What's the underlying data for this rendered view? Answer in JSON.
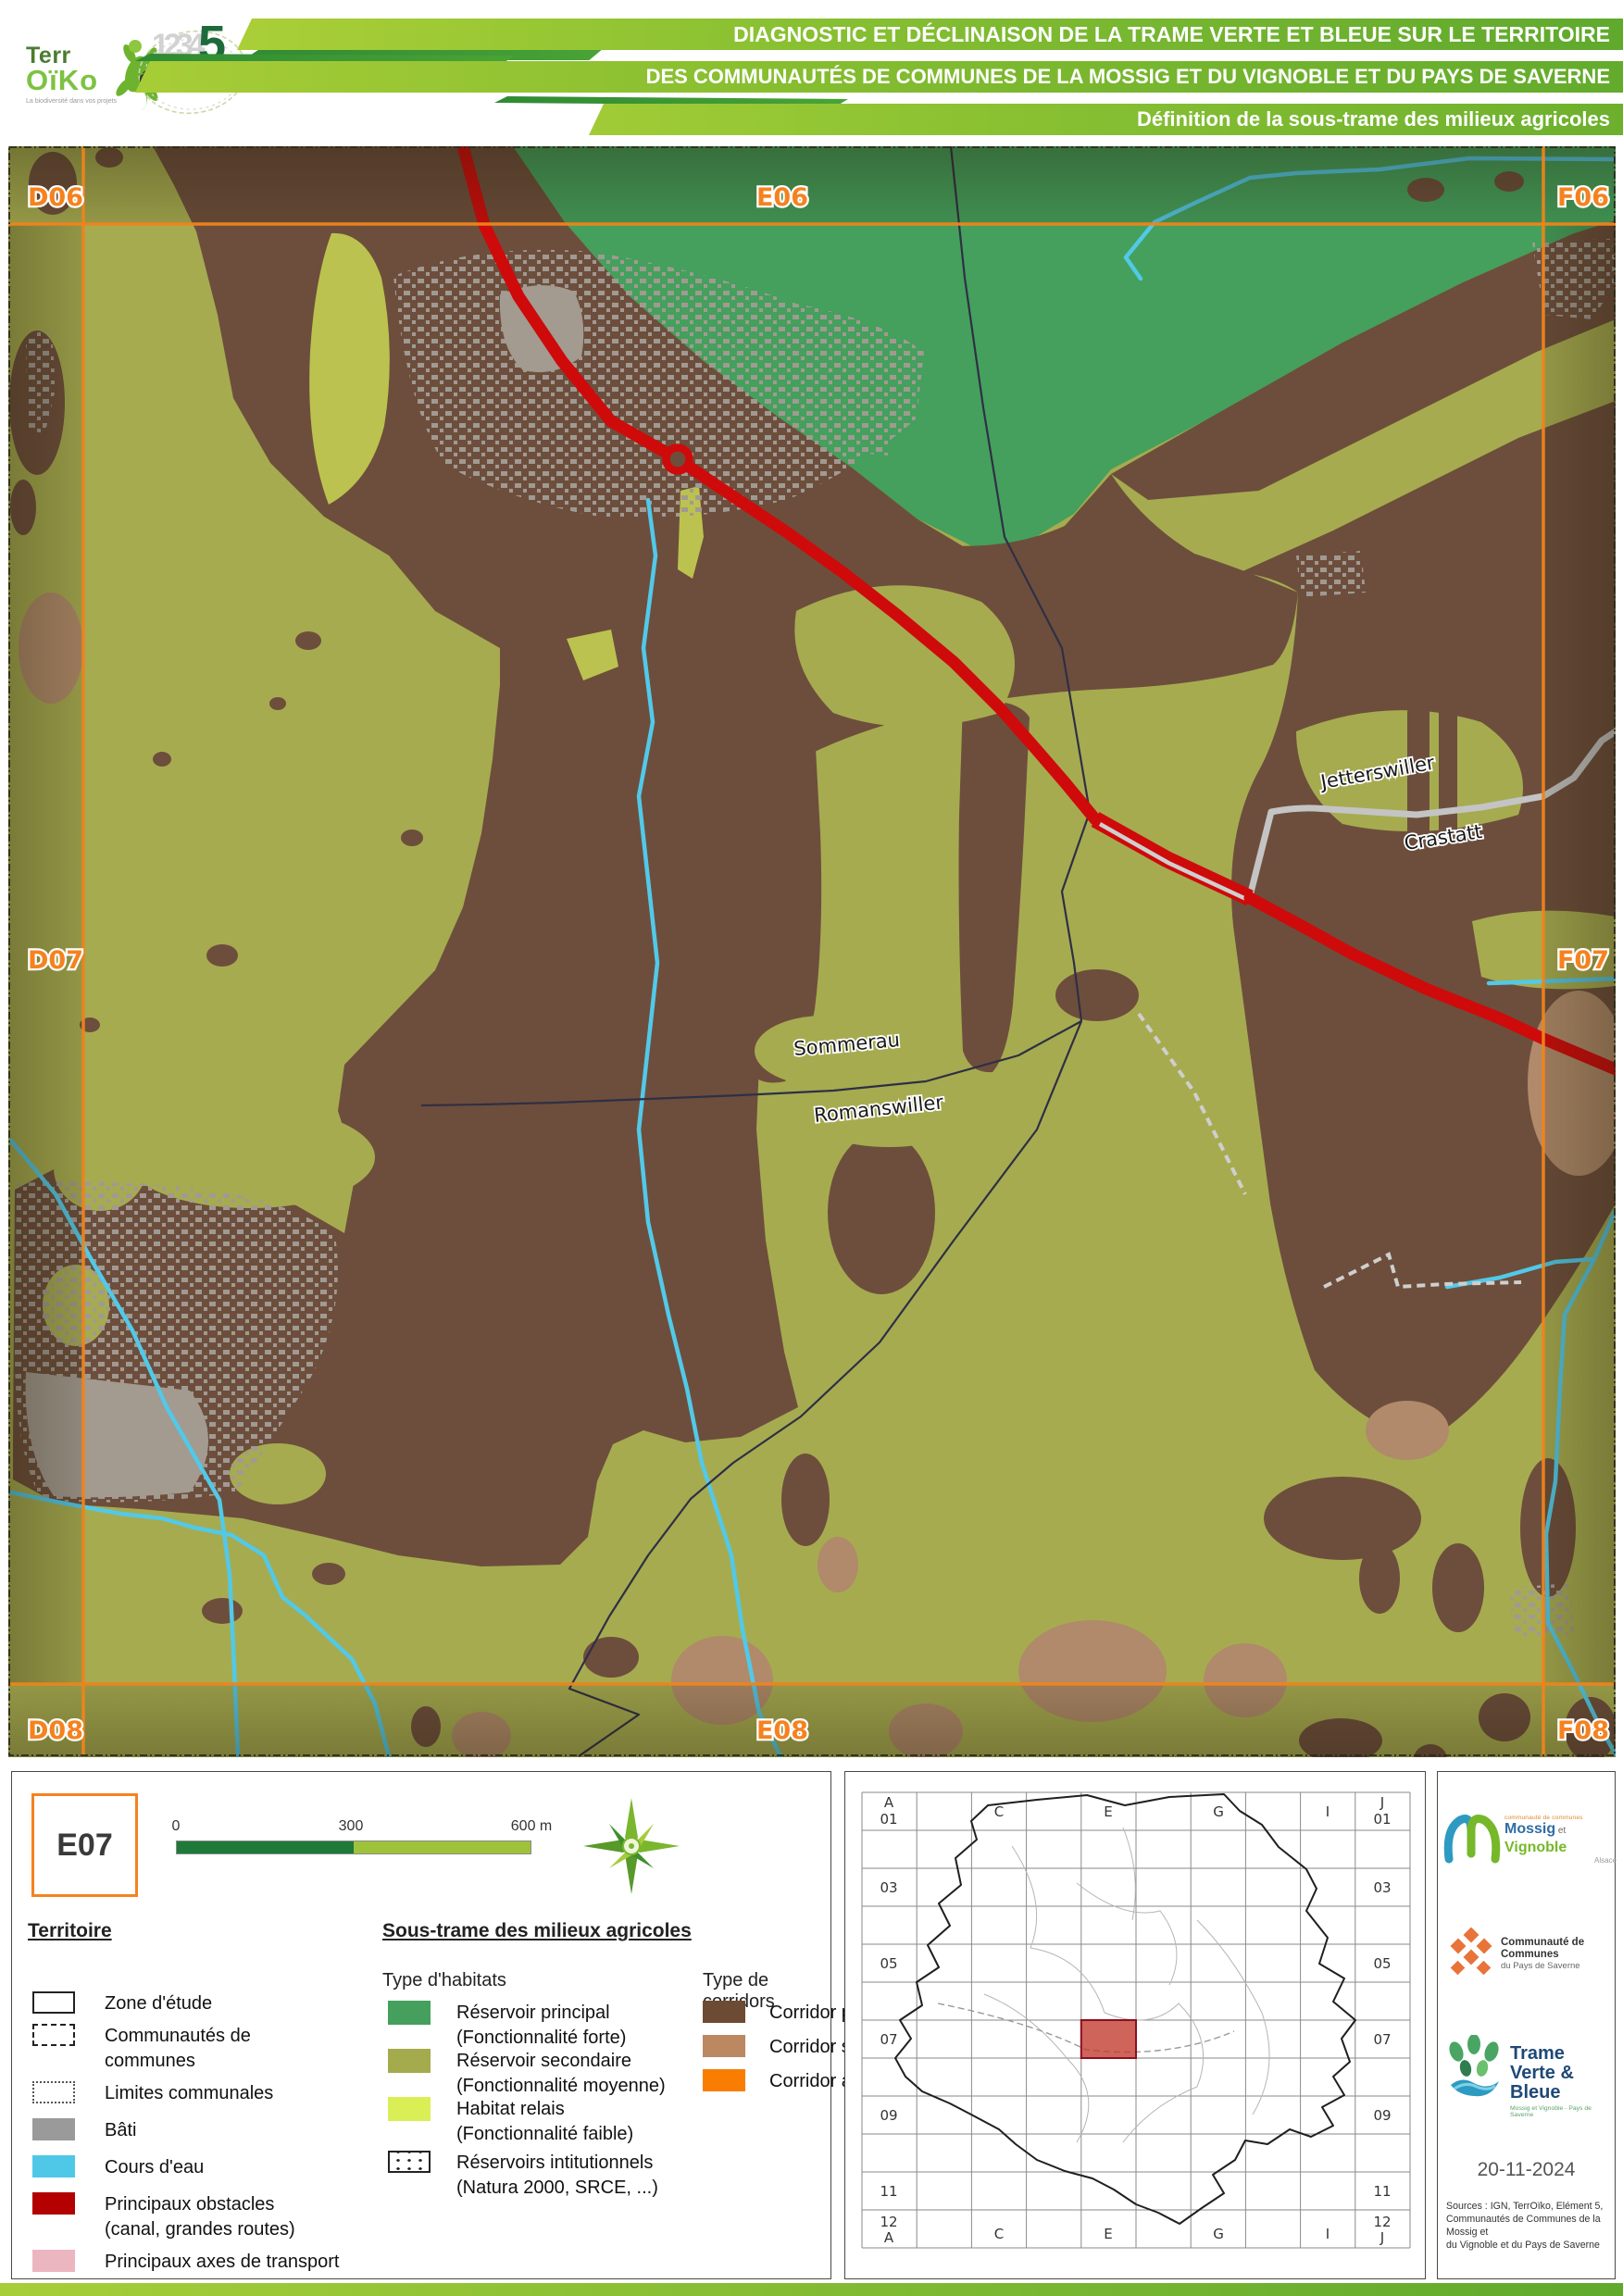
{
  "header": {
    "title_line1": "DIAGNOSTIC ET DÉCLINAISON DE LA TRAME VERTE ET BLEUE SUR LE TERRITOIRE",
    "title_line2": "DES COMMUNAUTÉS DE COMMUNES DE LA MOSSIG ET DU VIGNOBLE ET DU PAYS DE SAVERNE",
    "title_line3": "Définition de la sous-trame des milieux agricoles",
    "terroiko": {
      "line1": "Terr",
      "line2": "OïKo",
      "tagline": "La biodiversité dans vos projets"
    },
    "element5": {
      "numbers": "1234",
      "five": "5",
      "word1": "élément",
      "word2": "cinq"
    }
  },
  "map": {
    "grid": {
      "d06": "D06",
      "e06": "E06",
      "f06": "F06",
      "d07": "D07",
      "f07": "F07",
      "d08": "D08",
      "e08": "E08",
      "f08": "F08"
    },
    "labels": {
      "sommerau": "Sommerau",
      "romanswiller": "Romanswiller",
      "jetterswiller": "Jetterswiller",
      "crastatt": "Crastatt"
    },
    "colors": {
      "reservoir_principal": "#44a05c",
      "reservoir_secondaire": "#a6ab50",
      "habitat_relais": "#d9ef55",
      "corridor_principal": "#6d4e3c",
      "corridor_secondaire": "#b08a6a",
      "bati": "#a09a92",
      "cours_eau": "#52c9e8",
      "obstacle": "#cf0a0a",
      "axes_transport": "#ecb6c0",
      "grille": "#f0841c"
    }
  },
  "legend": {
    "cell_id": "E07",
    "scale": {
      "t0": "0",
      "t300": "300",
      "t600": "600 m"
    },
    "territoire": {
      "heading": "Territoire",
      "items": [
        {
          "label": "Zone d'étude"
        },
        {
          "label": "Communautés de",
          "label2": "communes"
        },
        {
          "label": "Limites communales"
        },
        {
          "label": "Bâti"
        },
        {
          "label": "Cours d'eau"
        },
        {
          "label": "Principaux obstacles",
          "label2": "(canal, grandes routes)"
        },
        {
          "label": "Principaux axes de transport"
        }
      ]
    },
    "sous_trame": {
      "heading": "Sous-trame des milieux agricoles",
      "habitats_title": "Type d'habitats",
      "habitats": [
        {
          "label": "Réservoir principal",
          "label2": "(Fonctionnalité forte)"
        },
        {
          "label": "Réservoir secondaire",
          "label2": "(Fonctionnalité moyenne)"
        },
        {
          "label": "Habitat relais",
          "label2": "(Fonctionnalité faible)"
        },
        {
          "label": "Réservoirs intitutionnels",
          "label2": "(Natura 2000, SRCE, ...)"
        }
      ],
      "corridors_title": "Type de corridors",
      "corridors": [
        {
          "label": "Corridor principal"
        },
        {
          "label": "Corridor secondaire"
        },
        {
          "label": "Corridor à restaurer"
        }
      ]
    }
  },
  "inset": {
    "colA": "A",
    "colC": "C",
    "colE": "E",
    "colG": "G",
    "colI": "I",
    "colJ": "J",
    "r01": "01",
    "r03": "03",
    "r05": "05",
    "r07": "07",
    "r09": "09",
    "r11": "11",
    "r12": "12",
    "highlight_cell": "E07"
  },
  "credits": {
    "mossig": {
      "small": "communauté de communes",
      "name1": "Mossig",
      "et": " et ",
      "name2": "Vignoble",
      "region": "Alsace"
    },
    "saverne": {
      "name": "Communauté de Communes",
      "sub": "du Pays de Saverne"
    },
    "tvb": {
      "line1": "Trame",
      "line2": "Verte & Bleue",
      "sub": "Mossig et Vignoble - Pays de Saverne"
    },
    "date": "20-11-2024",
    "sources_l1": "Sources : IGN, TerrOïko, Elément 5,",
    "sources_l2": "Communautés de Communes de la Mossig et",
    "sources_l3": "du Vignoble et du Pays de Saverne"
  }
}
